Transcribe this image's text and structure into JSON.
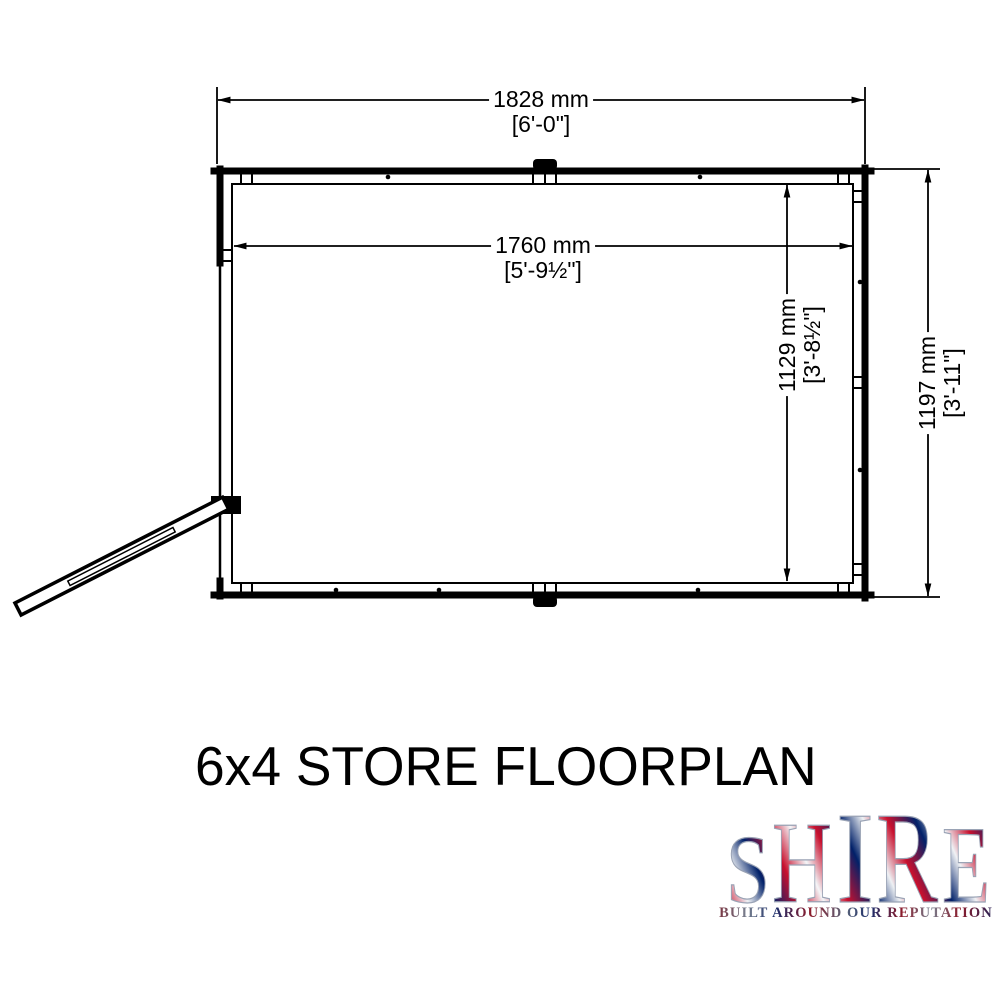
{
  "title": "6x4 STORE FLOORPLAN",
  "dimensions": {
    "outer_width": {
      "metric": "1828 mm",
      "imperial": "[6'-0\"]"
    },
    "inner_width": {
      "metric": "1760 mm",
      "imperial": "[5'-9½\"]"
    },
    "inner_depth": {
      "metric": "1129 mm",
      "imperial": "[3'-8½\"]"
    },
    "outer_depth": {
      "metric": "1197 mm",
      "imperial": "[3'-11\"]"
    }
  },
  "logo": {
    "letters": [
      "S",
      "H",
      "I",
      "R",
      "E"
    ],
    "tagline": "BUILT AROUND OUR REPUTATION",
    "colors": {
      "flag_red": "#c8102e",
      "flag_navy": "#012169",
      "silver": "#8e99ad"
    }
  }
}
